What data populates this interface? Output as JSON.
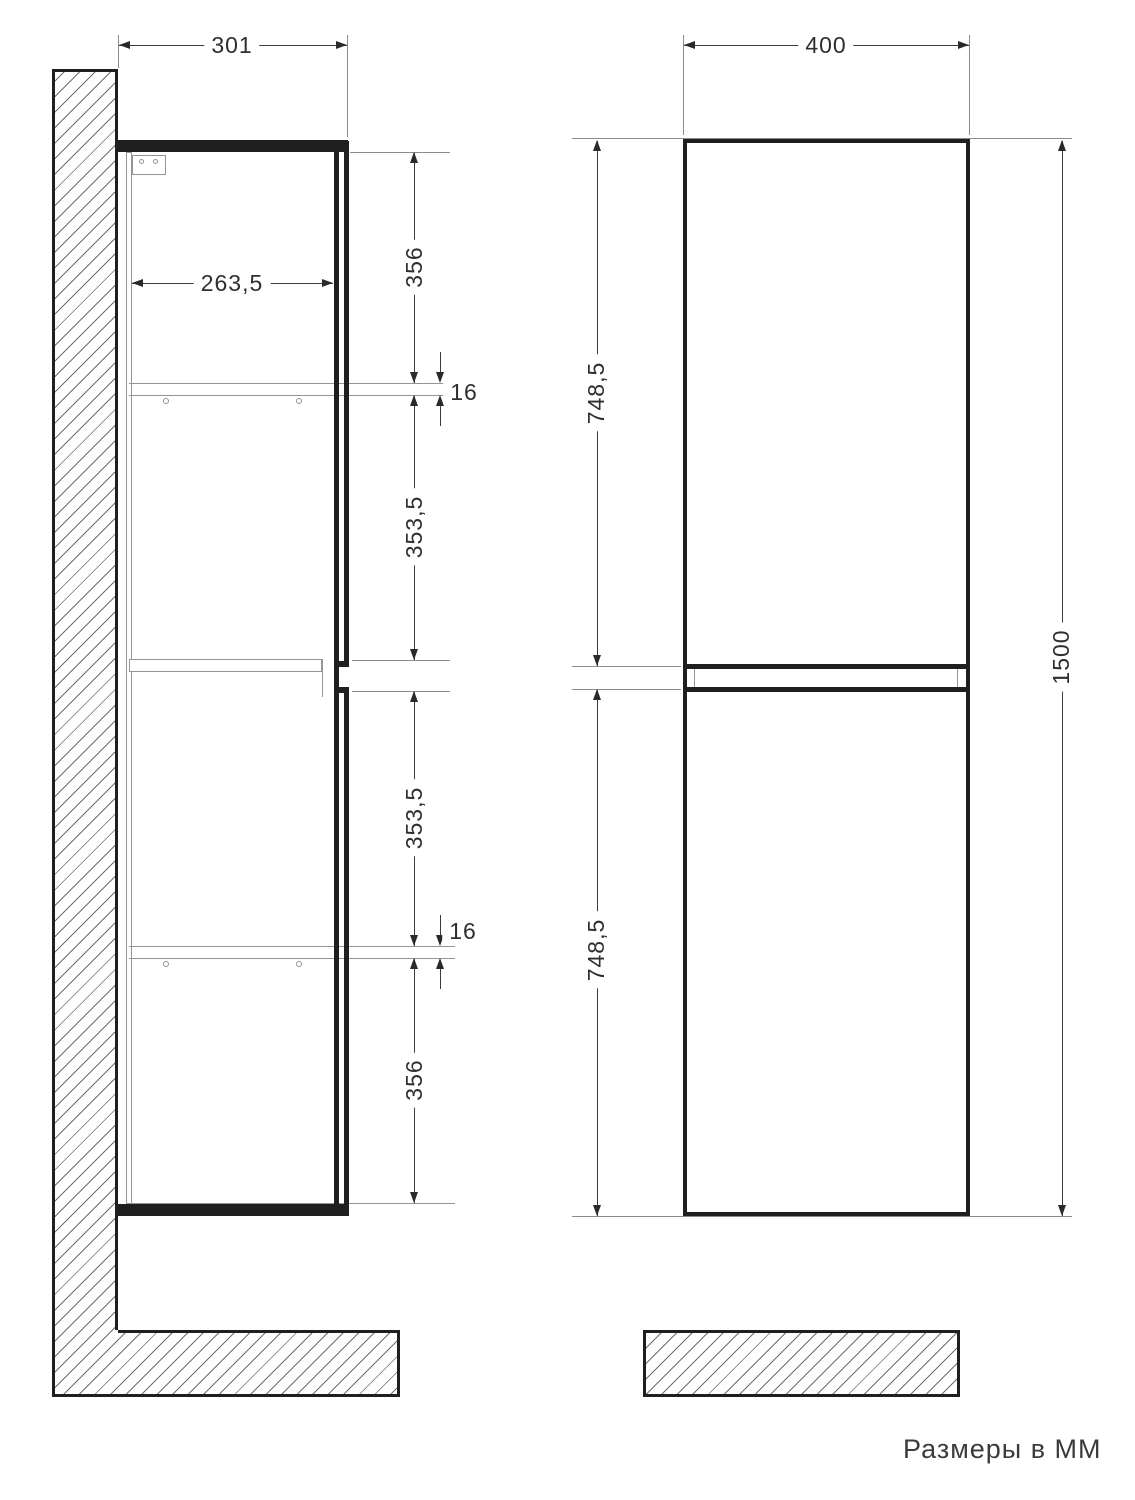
{
  "sheet": {
    "units_note": "Размеры в ММ"
  },
  "side_view": {
    "depth_total": "301",
    "depth_inner": "263,5",
    "top_to_shelf": "356",
    "shelf_thickness_top": "16",
    "shelf_to_middle_upper": "353,5",
    "middle_to_shelf_lower": "353,5",
    "shelf_thickness_bottom": "16",
    "shelf_to_bottom": "356"
  },
  "front_view": {
    "width": "400",
    "door_height_upper": "748,5",
    "door_height_lower": "748,5",
    "height_total": "1500"
  },
  "colors": {
    "ink": "#1f1f1f",
    "dim_line": "#3d3d3d",
    "aux_gray": "#8c8c8c",
    "text": "#2f2f2f"
  }
}
